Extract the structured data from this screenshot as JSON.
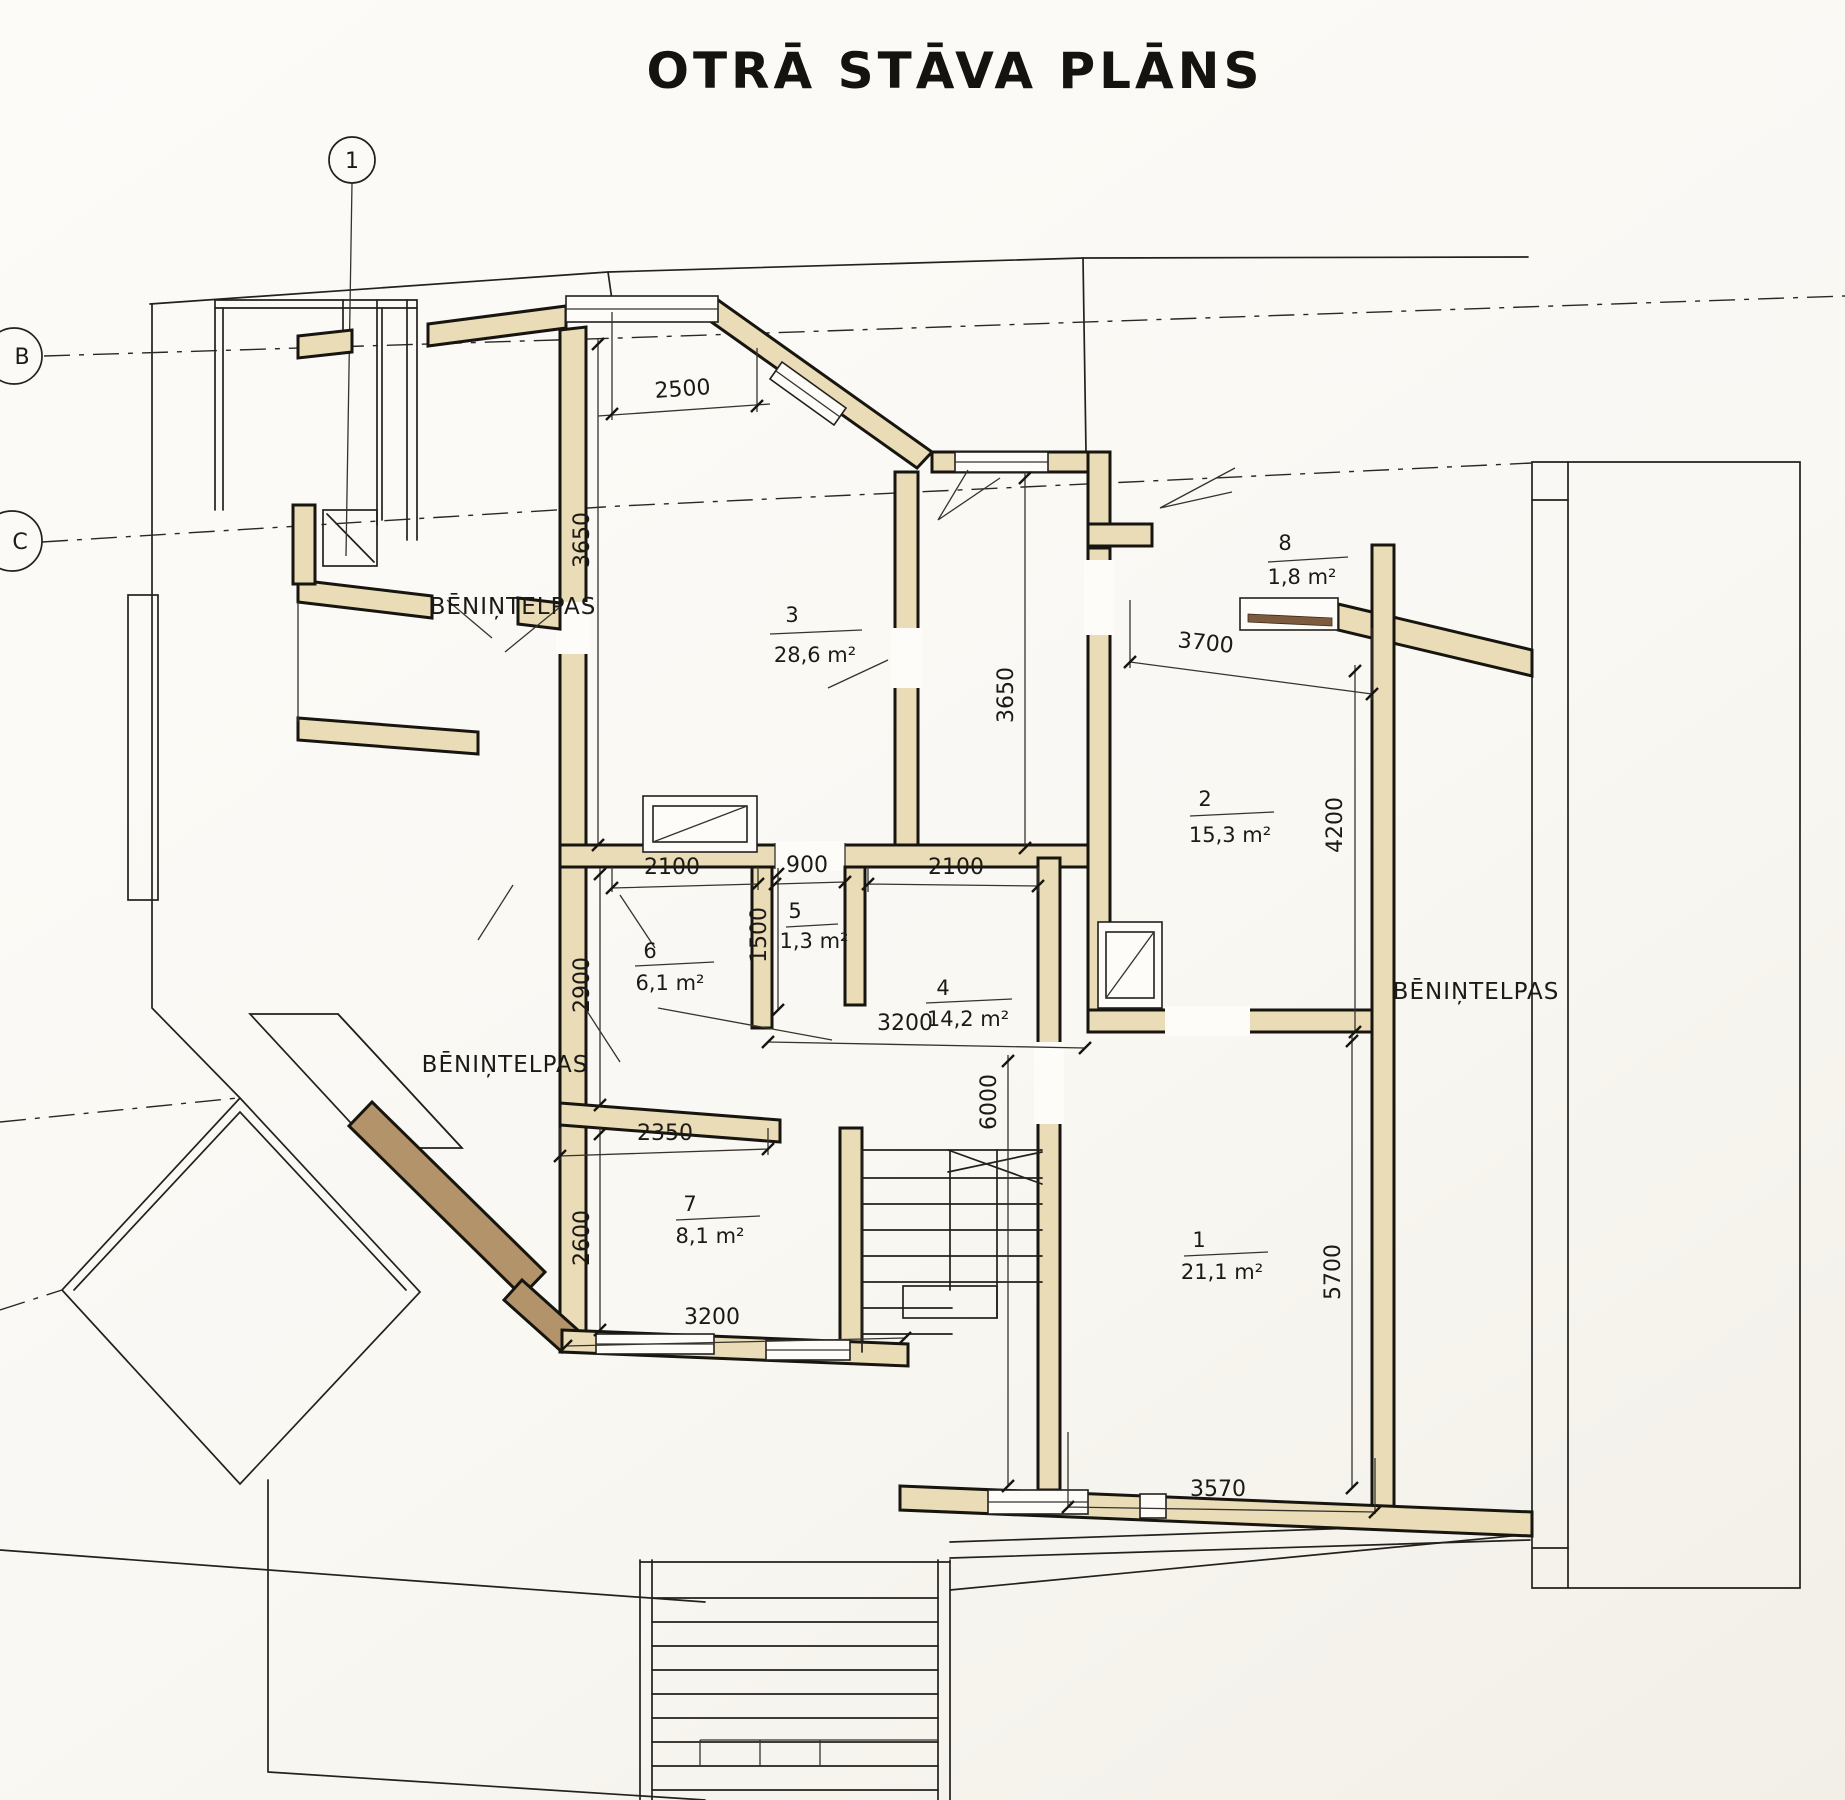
{
  "title": "OTRĀ STĀVA PLĀNS",
  "axes": {
    "top": "1",
    "left_upper": "B",
    "left_lower": "C"
  },
  "attic": {
    "top_left": "BĒNIŅTELPAS",
    "mid_left": "BĒNIŅTELPAS",
    "right": "BĒNIŅTELPAS"
  },
  "rooms": [
    {
      "number": "1",
      "area": "21,1 m²"
    },
    {
      "number": "2",
      "area": "15,3 m²"
    },
    {
      "number": "3",
      "area": "28,6 m²"
    },
    {
      "number": "4",
      "area": "14,2 m²"
    },
    {
      "number": "5",
      "area": "1,3 m²"
    },
    {
      "number": "6",
      "area": "6,1 m²"
    },
    {
      "number": "7",
      "area": "8,1 m²"
    },
    {
      "number": "8",
      "area": "1,8 m²"
    }
  ],
  "dimensions": {
    "top_window": "2500",
    "room3_left_height": "3650",
    "room3_right_height": "3650",
    "room2_top_width": "3700",
    "room2_right_height": "4200",
    "corridor_left": "2100",
    "corridor_door": "900",
    "corridor_right": "2100",
    "room5_height": "1500",
    "room6_height": "2900",
    "room4_width": "3200",
    "stair_depth": "6000",
    "room7_top_width": "2350",
    "room7_height": "2600",
    "room7_width": "3200",
    "room1_right_height": "5700",
    "room1_bottom_width": "3570"
  },
  "colors": {
    "wall_fill": "#e9dcb6",
    "wall_fill_dark": "#b2936a",
    "sill": "#7d5b3e",
    "line": "#23211e",
    "paper": "#fbf9f4"
  }
}
